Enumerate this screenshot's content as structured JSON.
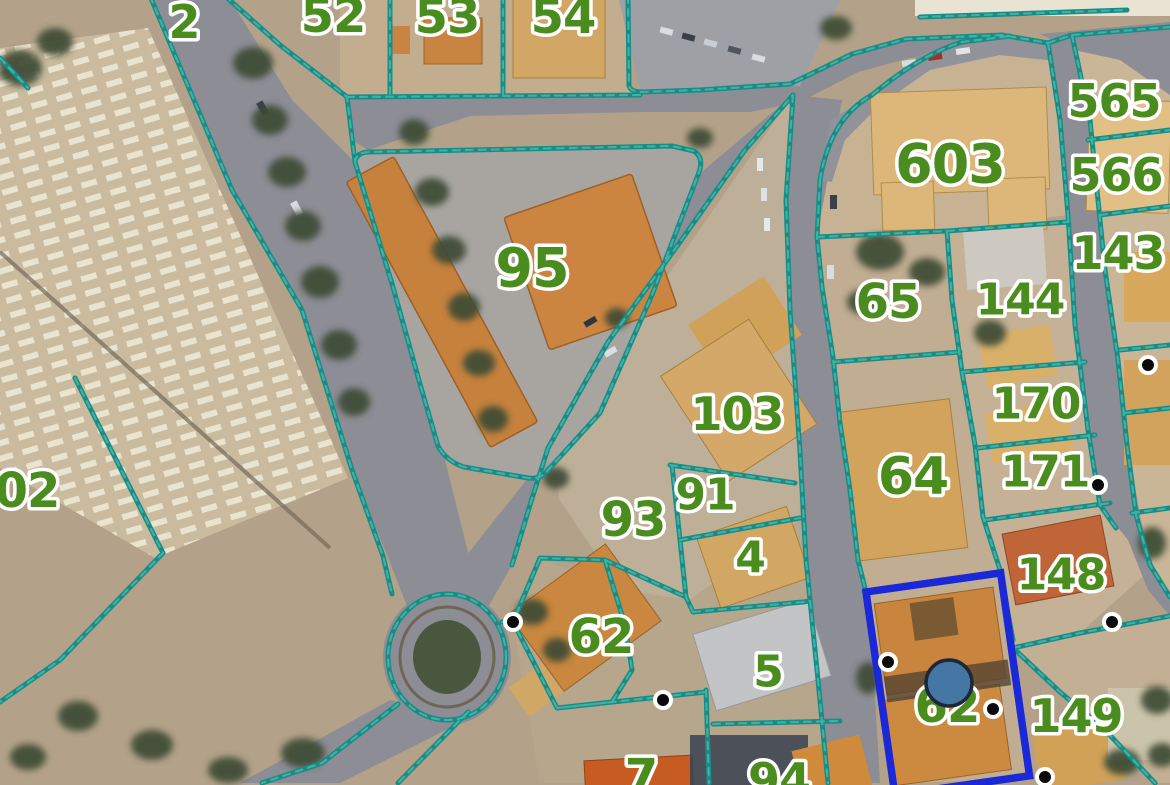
{
  "map": {
    "parcel_labels": [
      {
        "text": "2",
        "x": 184,
        "y": 22,
        "size": 46
      },
      {
        "text": "52",
        "x": 333,
        "y": 16,
        "size": 48
      },
      {
        "text": "53",
        "x": 447,
        "y": 17,
        "size": 48
      },
      {
        "text": "54",
        "x": 563,
        "y": 17,
        "size": 48
      },
      {
        "text": "95",
        "x": 532,
        "y": 268,
        "size": 54
      },
      {
        "text": "603",
        "x": 950,
        "y": 164,
        "size": 54
      },
      {
        "text": "565",
        "x": 1114,
        "y": 101,
        "size": 46
      },
      {
        "text": "566",
        "x": 1116,
        "y": 175,
        "size": 46
      },
      {
        "text": "143",
        "x": 1118,
        "y": 253,
        "size": 46
      },
      {
        "text": "144",
        "x": 1020,
        "y": 300,
        "size": 44
      },
      {
        "text": "65",
        "x": 888,
        "y": 302,
        "size": 48
      },
      {
        "text": "170",
        "x": 1036,
        "y": 404,
        "size": 44
      },
      {
        "text": "64",
        "x": 913,
        "y": 477,
        "size": 52
      },
      {
        "text": "171",
        "x": 1045,
        "y": 472,
        "size": 44
      },
      {
        "text": "148",
        "x": 1061,
        "y": 575,
        "size": 44
      },
      {
        "text": "103",
        "x": 737,
        "y": 414,
        "size": 46
      },
      {
        "text": "91",
        "x": 705,
        "y": 495,
        "size": 44
      },
      {
        "text": "93",
        "x": 633,
        "y": 520,
        "size": 48
      },
      {
        "text": "4",
        "x": 750,
        "y": 558,
        "size": 44
      },
      {
        "text": "62",
        "x": 601,
        "y": 637,
        "size": 48
      },
      {
        "text": "5",
        "x": 768,
        "y": 672,
        "size": 44
      },
      {
        "text": "62",
        "x": 947,
        "y": 706,
        "size": 48
      },
      {
        "text": "149",
        "x": 1076,
        "y": 716,
        "size": 46
      },
      {
        "text": "02",
        "x": 27,
        "y": 491,
        "size": 48
      },
      {
        "text": "7",
        "x": 641,
        "y": 777,
        "size": 48
      },
      {
        "text": "94",
        "x": 779,
        "y": 780,
        "size": 46
      }
    ],
    "survey_markers": [
      {
        "x": 513,
        "y": 622
      },
      {
        "x": 663,
        "y": 700
      },
      {
        "x": 888,
        "y": 662
      },
      {
        "x": 993,
        "y": 709
      },
      {
        "x": 1112,
        "y": 622
      },
      {
        "x": 1045,
        "y": 777
      },
      {
        "x": 1148,
        "y": 365
      },
      {
        "x": 1098,
        "y": 485
      }
    ],
    "selected_parcel": {
      "label": "62",
      "marker": {
        "x": 949,
        "y": 683,
        "r": 23
      }
    }
  },
  "colors": {
    "boundary": "#1a8c85",
    "boundary_light": "#3db3a8",
    "label_green": "#4b8c1f",
    "label_halo": "#ffffff",
    "highlight_blue": "#1b28d8",
    "marker_fill": "#4577a5",
    "marker_ring": "#1d2735",
    "survey_dot": "#0a0a0a",
    "survey_ring": "#ffffff"
  }
}
